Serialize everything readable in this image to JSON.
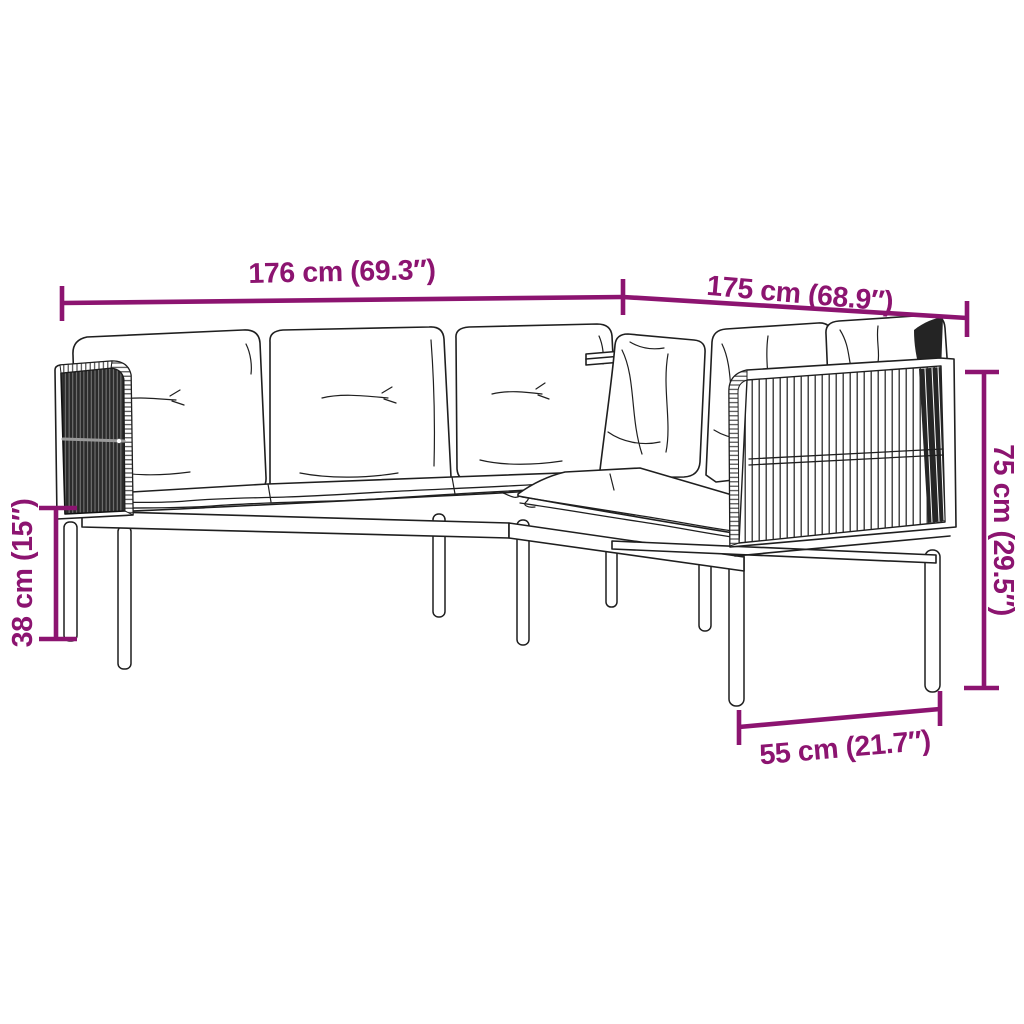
{
  "diagram": {
    "subject": "L-shaped garden corner sofa with cushions — technical dimension sketch",
    "background_color": "#ffffff",
    "sketch_line_color": "#1f1f1f",
    "accent_color": "#8C1470",
    "panel_dark_color": "#2b2b2b"
  },
  "dimension_labels": {
    "top_left_width": "176 cm (69.3″)",
    "top_right_width": "175 cm (68.9″)",
    "total_height": "75 cm (29.5″)",
    "seat_height": "38 cm (15″)",
    "seat_depth": "55 cm (21.7″)"
  }
}
